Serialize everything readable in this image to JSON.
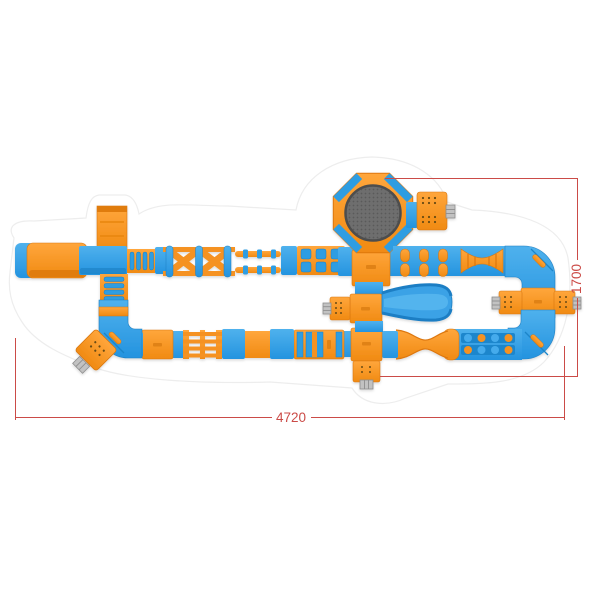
{
  "diagram": {
    "type": "top-view product dimension diagram",
    "subject": "inflatable floating water park obstacle course",
    "dimensions": {
      "width_label": "4720",
      "height_label": "1700"
    },
    "colors": {
      "module_blue": "#2F9DE2",
      "module_blue_dark": "#1D7FC2",
      "module_orange": "#F59220",
      "module_orange_dark": "#DD7711",
      "trampoline_mesh_gray": "#6E6E6E",
      "ladder_gray": "#C2C2C2",
      "dimension_line_red": "#CB4B47",
      "background": "#FFFFFF"
    },
    "modules": [
      "start-platform",
      "overhead-walkway",
      "corner-junction",
      "rung-walkway",
      "x-crisscross-obstacle",
      "balance-beams",
      "stepping-grid",
      "octagon-trampoline",
      "entry-platform-with-ladder",
      "dumbbell-obstacles",
      "roller-obstacle",
      "corner-elbow",
      "side-entry-platforms",
      "stepping-stones",
      "hourglass-walkway",
      "water-slide",
      "exit-platform-with-ladder",
      "tilted-entry-platform"
    ]
  }
}
